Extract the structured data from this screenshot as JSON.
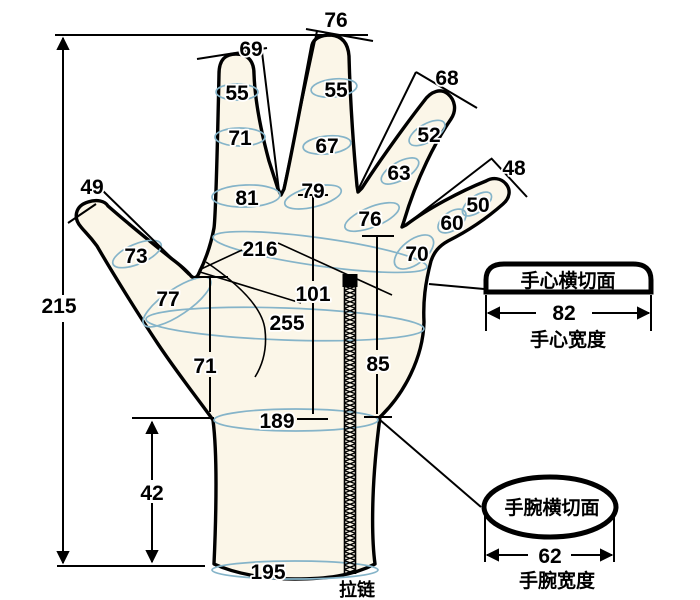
{
  "diagram_title": "glove-hand-measurement-diagram",
  "colors": {
    "hand_fill": "#FBF6E8",
    "girth_ellipse": "#85B4C9",
    "outline": "#000000",
    "background": "#FFFFFF"
  },
  "measurements": {
    "total_length": "215",
    "thumb_length": "49",
    "index_length": "69",
    "middle_length": "76",
    "ring_length": "68",
    "pinky_length": "48",
    "thumb_girth_tip": "73",
    "thumb_girth_base": "77",
    "index_girth_tip": "55",
    "index_girth_mid": "71",
    "index_girth_base": "81",
    "middle_girth_tip": "55",
    "middle_girth_mid": "67",
    "middle_girth_base": "79",
    "ring_girth_tip": "52",
    "ring_girth_mid": "63",
    "ring_girth_base": "76",
    "pinky_girth_tip": "50",
    "pinky_girth_mid": "60",
    "pinky_girth_base": "70",
    "knuckle_girth": "216",
    "palm_girth": "255",
    "palm_length": "101",
    "thumb_base_to_wrist": "71",
    "knuckle_to_wrist": "85",
    "wrist_girth": "189",
    "cuff_height": "42",
    "cuff_girth": "195",
    "palm_width": "82",
    "wrist_width": "62"
  },
  "labels": {
    "zipper": "拉链",
    "palm_cross_section": "手心横切面",
    "palm_width_caption": "手心宽度",
    "wrist_cross_section": "手腕横切面",
    "wrist_width_caption": "手腕宽度"
  }
}
